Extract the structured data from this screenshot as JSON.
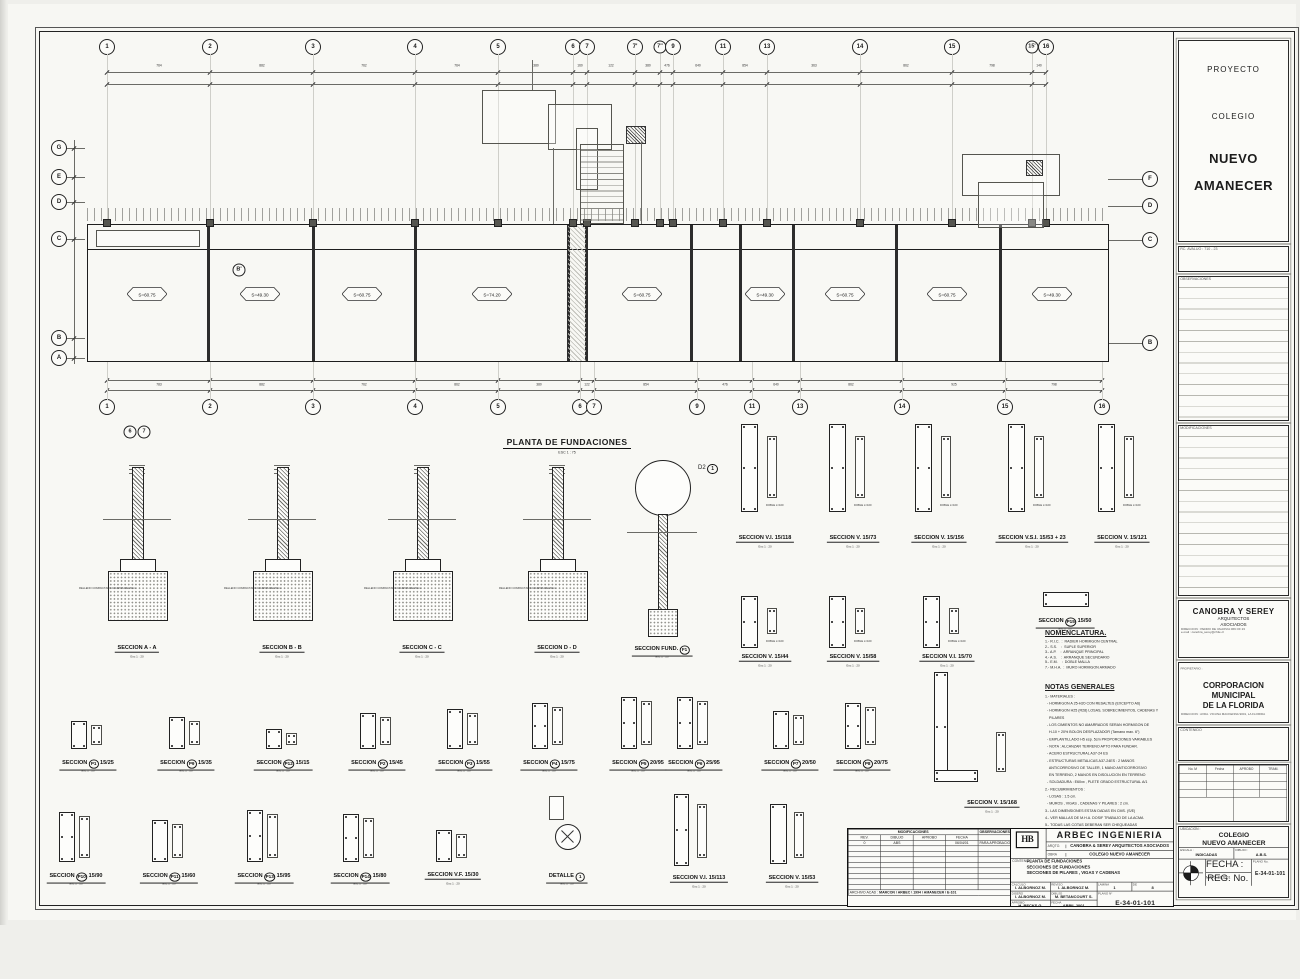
{
  "side_panel": {
    "project_label": "PROYECTO",
    "project_line1": "COLEGIO",
    "project_line2": "NUEVO",
    "project_line3": "AMANECER",
    "rol_label": "RC. AVALUO :   710 - 23",
    "observaciones_header": "OBSERVACIONES",
    "modificaciones_header": "MODIFICACIONES",
    "architects_name": "CANOBRA Y SEREY",
    "architects_sub1": "ARQUITECTOS",
    "architects_sub2": "ASOCIADOS",
    "architects_addr1": "DIRECCION : PEDRO DE VALDIVIA 069 OF 23",
    "architects_addr2": "e-mail : canobra_serey@chile.cl",
    "owner_label": "PROPIETARIO :",
    "owner_line1": "CORPORACION",
    "owner_line2": "MUNICIPAL",
    "owner_line3": "DE LA FLORIDA",
    "owner_addr": "DIRECCION : AVDA. VICUNA MACKENNA 9001, LA FLORIDA",
    "contenido_label": "CONTENIDO",
    "approval_headers": [
      "No. M",
      "Fecha",
      "APROBO",
      "TRAM."
    ],
    "firma_left": "FIRMA PROPIETARIO",
    "firma_right": "FIRMA ARQUITECTO",
    "id_label": "UBICACION :",
    "id_line1": "COLEGIO",
    "id_line2": "NUEVO AMANECER",
    "escala_label": "ESCALA :",
    "escala_value": "INDICADAS",
    "dibujo_label": "DIBUJO :",
    "dibujo_value": "A.B.S.",
    "fecha_label": "FECHA :",
    "fecha_value": "MAYO 19 2001",
    "reg_label": "REG. No.",
    "plano_label": "PLANO No.",
    "plano_value": "E-34-01-101"
  },
  "titleblock": {
    "mods_header": "MODIFICACIONES",
    "obs_header": "OBSERVACIONES",
    "mods_cols": [
      "REV.",
      "DIBUJO",
      "APROBO",
      "FECHA"
    ],
    "mods_row": [
      "0",
      "ABS",
      "",
      "06/04/01",
      "PARA APROBACION"
    ],
    "archivo_label": "ARCHIVO ACAD :",
    "archivo_value": "MARCON \\ ARBEC \\ 1994 \\ AMANECER \\ E-101",
    "logo": "HB",
    "company": "ARBEC  INGENIERIA",
    "arqto_label": "ARQTO.",
    "arqto_value": "CANOBRA & SEREY ARQUITECTOS ASOCIADOS",
    "obra_label": "OBRA",
    "obra_value": "COLEGIO NUEVO AMANECER",
    "contenido_label": "CONTENIDO :",
    "contenido_lines": [
      "PLANTA DE FUNDACIONES",
      "SECCIONES DE FUNDACIONES",
      "SECCIONES DE PILARES , VIGAS Y CADENAS"
    ],
    "fields": [
      {
        "label": "CALCULO",
        "value": "I. ALBORNOZ M."
      },
      {
        "label": "REVISO",
        "value": "I. ALBORNOZ M."
      },
      {
        "label": "LAMINA",
        "value": "1"
      },
      {
        "label": "DE",
        "value": "8"
      },
      {
        "label": "DISEÑO",
        "value": "I. ALBORNOZ M."
      },
      {
        "label": "DIBUJO",
        "value": "M. BETANCOURT S."
      },
      {
        "label": "APROBO",
        "value": "H. BECKS G."
      },
      {
        "label": "FECHA",
        "value": "ABRIL 2001"
      }
    ],
    "plano_label": "PLANO N°",
    "plano_value": "E-34-01-101"
  },
  "plan": {
    "title": "PLANTA DE FUNDACIONES",
    "scale": "ESC  1 : 75",
    "grid_top": [
      {
        "label": "1",
        "x": 67
      },
      {
        "label": "2",
        "x": 170
      },
      {
        "label": "3",
        "x": 273
      },
      {
        "label": "4",
        "x": 375
      },
      {
        "label": "5",
        "x": 458
      },
      {
        "label": "6",
        "x": 533
      },
      {
        "label": "7",
        "x": 547
      },
      {
        "label": "7'",
        "x": 595
      },
      {
        "label": "7''",
        "x": 620
      },
      {
        "label": "9",
        "x": 633
      },
      {
        "label": "11",
        "x": 683
      },
      {
        "label": "13",
        "x": 727
      },
      {
        "label": "14",
        "x": 820
      },
      {
        "label": "15",
        "x": 912
      },
      {
        "label": "15'",
        "x": 992
      },
      {
        "label": "16",
        "x": 1006
      }
    ],
    "grid_bottom": [
      {
        "label": "1",
        "x": 67
      },
      {
        "label": "2",
        "x": 170
      },
      {
        "label": "3",
        "x": 273
      },
      {
        "label": "4",
        "x": 375
      },
      {
        "label": "5",
        "x": 458
      },
      {
        "label": "6",
        "x": 540
      },
      {
        "label": "7",
        "x": 554
      },
      {
        "label": "9",
        "x": 657
      },
      {
        "label": "11",
        "x": 712
      },
      {
        "label": "13",
        "x": 760
      },
      {
        "label": "14",
        "x": 862
      },
      {
        "label": "15",
        "x": 965
      },
      {
        "label": "16",
        "x": 1062
      }
    ],
    "grid_left": [
      {
        "label": "G",
        "y": 116
      },
      {
        "label": "E",
        "y": 145
      },
      {
        "label": "D",
        "y": 170
      },
      {
        "label": "C",
        "y": 207
      },
      {
        "label": "B",
        "y": 306
      },
      {
        "label": "A",
        "y": 326
      }
    ],
    "grid_right": [
      {
        "label": "F",
        "y": 147
      },
      {
        "label": "D",
        "y": 174
      },
      {
        "label": "C",
        "y": 208
      },
      {
        "label": "B",
        "y": 311
      }
    ],
    "top_dims": [
      "764",
      "882",
      "762",
      "764",
      "380",
      "160",
      "122",
      "380",
      "476",
      "640",
      "854",
      "363",
      "862",
      "798",
      "140"
    ],
    "bottom_dims": [
      "783",
      "882",
      "762",
      "862",
      "380",
      "122",
      "854",
      "476",
      "640",
      "862",
      "925",
      "798"
    ],
    "walls_x": [
      167,
      272,
      374,
      527,
      545,
      650,
      699,
      752,
      855,
      959
    ],
    "rooms": [
      {
        "x": 107,
        "code": "S=60.75"
      },
      {
        "x": 220,
        "code": "S=49.30"
      },
      {
        "x": 322,
        "code": "S=60.75"
      },
      {
        "x": 452,
        "code": "S=74.20"
      },
      {
        "x": 602,
        "code": "S=60.75"
      },
      {
        "x": 725,
        "code": "S=49.30"
      },
      {
        "x": 805,
        "code": "S=60.75"
      },
      {
        "x": 907,
        "code": "S=60.75"
      },
      {
        "x": 1012,
        "code": "S=49.30"
      }
    ],
    "detail_bubble": "B'",
    "pair_bubbles": [
      "6",
      "7"
    ],
    "d2_label": "D2",
    "d2_circ": "1"
  },
  "sections": {
    "card_scale": "Esc 1 : 20",
    "footings": [
      {
        "x": 97,
        "label": "SECCION  A - A"
      },
      {
        "x": 242,
        "label": "SECCION  B - B"
      },
      {
        "x": 382,
        "label": "SECCION  C - C"
      },
      {
        "x": 517,
        "label": "SECCION  D - D"
      }
    ],
    "footing_note": "RELLENO COMPACTADO C/CAPAS DE 20cm",
    "fund_f1": {
      "x": 622,
      "label": "SECCION FUND.|F1"
    },
    "v_row1": [
      {
        "x": 725,
        "label": "SECCION V.I. 15/118"
      },
      {
        "x": 813,
        "label": "SECCION V. 15/73"
      },
      {
        "x": 899,
        "label": "SECCION V. 15/156"
      },
      {
        "x": 992,
        "label": "SECCION V.S.I. 15/53 + 23"
      },
      {
        "x": 1082,
        "label": "SECCION V. 15/121"
      }
    ],
    "p15": {
      "x": 1025,
      "label": "SECCION|P15|15/50"
    },
    "v_row2": [
      {
        "x": 725,
        "label": "SECCION V. 15/44"
      },
      {
        "x": 813,
        "label": "SECCION V. 15/58"
      },
      {
        "x": 907,
        "label": "SECCION V.I. 15/70"
      }
    ],
    "pilares_row1": [
      {
        "x": 48,
        "label": "SECCION|P1|15/25",
        "h": 26
      },
      {
        "x": 146,
        "label": "SECCION|P9|15/35",
        "h": 30
      },
      {
        "x": 243,
        "label": "SECCION|P12|15/15",
        "h": 18
      },
      {
        "x": 337,
        "label": "SECCION|P2|15/45",
        "h": 34
      },
      {
        "x": 424,
        "label": "SECCION|P3|15/55",
        "h": 38
      },
      {
        "x": 509,
        "label": "SECCION|P4|15/75",
        "h": 44
      },
      {
        "x": 598,
        "label": "SECCION|P5|20/95",
        "h": 50
      },
      {
        "x": 654,
        "label": "SECCION|P6|25/95",
        "h": 50
      },
      {
        "x": 750,
        "label": "SECCION|P7|20/50",
        "h": 36
      },
      {
        "x": 822,
        "label": "SECCION|P8|20/75",
        "h": 44
      }
    ],
    "pilares_row2": [
      {
        "x": 36,
        "label": "SECCION|P10|15/90",
        "h": 48
      },
      {
        "x": 129,
        "label": "SECCION|P11|15/60",
        "h": 40
      },
      {
        "x": 224,
        "label": "SECCION|P13|15/95",
        "h": 50
      },
      {
        "x": 320,
        "label": "SECCION|P14|15/80",
        "h": 46
      },
      {
        "x": 413,
        "label": "SECCION V.F. 15/30",
        "h": 30
      }
    ],
    "detalle": {
      "x": 527,
      "label": "DETALLE|1"
    },
    "v_113": {
      "x": 659,
      "label": "SECCION V.I. 15/113"
    },
    "v_53": {
      "x": 752,
      "label": "SECCION V. 15/53"
    },
    "v_168": {
      "x": 952,
      "label": "SECCION V. 15/168"
    },
    "rebar_note": "DOBLE L=100"
  },
  "notes": {
    "nomenclatura_title": "NOMENCLATURA.",
    "nomenclatura": [
      "1.- R.I.C.  :  RADIER HORMIGON CENTRAL",
      "2.- S.S.    :  SUPLE SUPERIOR",
      "3.- A.P.    :  ARRANQUE PRINCIPAL",
      "4.- A.S.    :  ARRANQUE SECUNDARIO",
      "5.- E.M.    :  DOBLE MALLA",
      "7.- M.H.A.  :  MURO HORMIGON ARMADO"
    ],
    "notas_title": "NOTAS GENERALES",
    "notas": [
      "1.- MATERIALES :",
      "  - HORMIGON A 25-H20 CON RESALTES (EXCEPTO A6)",
      "  - HORMIGON H25 (R28) LOSAS, SOBRECIMIENTOS, CADENAS Y",
      "    PILARES",
      "  - LOS CIMIENTOS NO AMARRADOS SERAN HORMIGON DE",
      "    H-10 + 20% BOLON DESPLAZADOR (Tamano max. 6\")",
      "  - EMPLANTILLADO H5 esp. 5cm PROPORCIONES VARIABLES",
      "  - NOTA : ALCANZAR TERRENO APTO PARA FUNDAR.",
      "  - ACERO ESTRUCTURAL A37-24 ES",
      "  - ESTRUCTURAS METALICAS A37-24ES : 2 MANOS",
      "    ANTICORROSIVO DE TALLER, 1 MANO ANTICORROSIVO",
      "    EN TERRENO, 2 MANOS EN DISOLUCION EN TERRENO",
      "  - SOLDADURA : E60xx , PLETE GRADO ESTRUCTURAL A/1",
      "2.- RECUBRIMIENTOS :",
      "  - LOSAS : 1.5 cm.",
      "  - MUROS , VIGAS , CADENAS Y PILARES : 2 cm.",
      "3.- LAS DIMENSIONES ESTAN DADAS EN CMS. (S/E)",
      "4.- VER MALLAS DE M.H.A. DOSIF TRABAJO DE LA ACMA",
      "5.- TODAS LAS COTAS DEBERAN SER CHEQUEADAS",
      "    POR ARQUITECTURA ANTES DE CONSTRUIR.",
      "6.- MADERAS ADOSABLES :   CENTRO :    DEMAS :",
      "7.- LOS PUENTES DE MURO SEGUN ARQUITECTURA."
    ]
  }
}
